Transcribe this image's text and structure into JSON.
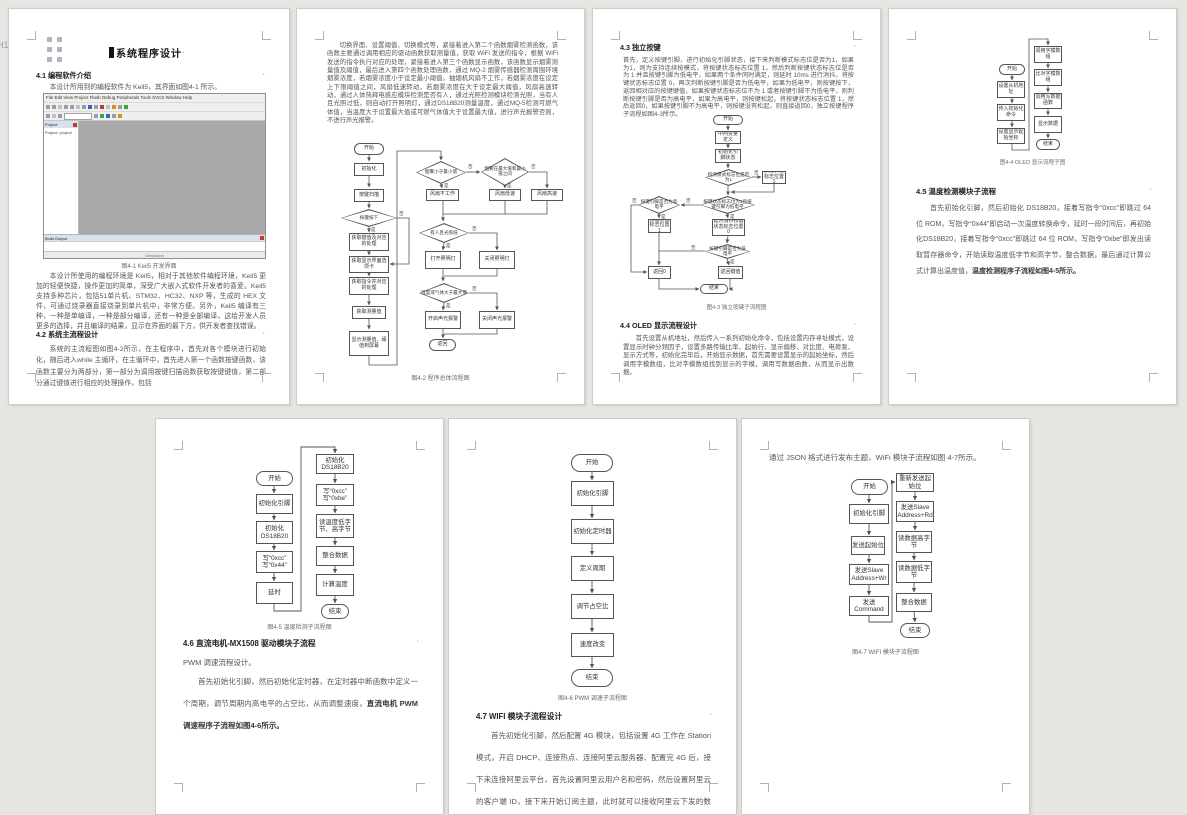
{
  "labels": {
    "yes": "是",
    "no": "否",
    "dot": "·",
    "h_level": "H1"
  },
  "page1": {
    "h1": "系统程序设计",
    "h2_41": "4.1 编程软件介绍",
    "p_intro": "本设计所用到的编程软件为 Keil5，其界面如图4-1 所示。",
    "keil": {
      "menu": "File  Edit  View  Project  Flash  Debug  Peripherals  Tools  SVCS  Window  Help",
      "project": "Project",
      "tree_item": "Project: project",
      "build_output": "Build Output",
      "status": "Simulation"
    },
    "caption": "图4-1 Keil5 开发界面",
    "p_keil": "本设计所使用的编程环境是 Keil5，相对于其他软件编程环境，Keil5 更加的轻便快捷，操作更加的简单，深受广大嵌入式软件开发者的喜爱。Keil5 支持多种芯片，包括51单片机、STM32、HC32、NXP 等，生成的 HEX 文件，可通过烧录器直接烧录到单片机中，非常方便。另外，Keil5 编译有三种，一种是单编译，一种是部分编译，还有一种是全部编译，这给开发人员更多的选择，并且编译的结果，显示在界面的最下方，供开发者查找错误。",
    "h2_42": "4.2 系统主流程设计",
    "p_42": "系统的主流程图如图4-2所示，在主程序中，首先对各个模块进行初始化，随后进入while 主循环，在主循环中，首先进入第一个函数按键函数，该函数主要分为两部分，第一部分为调用按键扫描函数获取按键键值，第二部分通过键值进行相应的处理操作，包括"
  },
  "page2": {
    "p_top": "切换界面、设置阈值、切换模式等，紧接着进入第二个函数烟雾检测函数，该函数主要通过调用相应的驱动函数获取测量值，获取 WiFi 发送的指令，根据 WiFi 发送的指令执行对应的处理，紧接着进入第三个函数显示函数，该函数显示烟雾测量值及阈值，最后进入第四个函数处理函数，通过 MQ-2 烟雾传感器检测周围环境烟雾浓度，若烟雾浓度小于设定最小阈值，抽烟机风扇不工作，若烟雾浓度在设定上下限阈值之间，风扇低速转动，若烟雾浓度在大于设定最大阈值，风扇高速转动，通过人体热释电感应模块检测是否有人，通过光照检测模块检测光照，当有人且光照过低，则自动打开照明灯，通过DS18B20测量温度，通过MQ-5检测可燃气体值，当温度大于设置最大值或可燃气体值大于设置最大值，进行声光报警否则，不进行声光报警。",
    "caption": "图4-2 程序总体流程图",
    "fc": {
      "start": "开始",
      "init": "初始化",
      "scan": "按键扫描",
      "d_press": "按键按下",
      "get_key": "获取键值及对应的处理",
      "get_page": "获取显示界面选项卡",
      "get_cmd": "获取指令并对应的处理",
      "get_val": "获取测量值",
      "show_val": "显示测量值、阈值到屏幕",
      "d_low": "烟雾小于最小值",
      "d_mid": "烟雾在最大值和最小值之间",
      "fan_off": "风扇不工作",
      "fan_low": "风扇低速",
      "fan_high": "风扇高速",
      "d_person": "有人且光照低",
      "lamp_on": "打开照明灯",
      "lamp_off": "关闭照明灯",
      "d_alarm": "温度或气体大于最大值",
      "alarm_on": "开启声光报警",
      "alarm_off": "关闭声光报警",
      "ret": "返回"
    }
  },
  "page3": {
    "h2_43": "4.3 独立按键",
    "p_43": "首先，定义按键引脚，进行初始化引脚状态，接下来判断模式标志位是否为1，如果为1，则为支持连续按模式，将按键状态标志位置 1，然后判断按键状态标志位是否为 1 并且按键引脚为低电平，如果两个条件同时满足，则延时 10ms 进行消抖，将按键状态标志位置 0，再次判断按键引脚是否为低电平，如果为低电平，则按键按下，返回相对应的按键键值，如果按键状态标志位不为 1 或者按键引脚不为低电平，则判断按键引脚是否为高电平，如果为高电平，则按键松起，将按键状态标志位置 1，然后返回0，如果按键引脚不为高电平，则按键没有松起，则直接返回0，独立按键程序子流程如图4-3所示。",
    "caption": "图4-3 独立按键子流程图",
    "h2_44": "4.4 OLED 显示流程设计",
    "p_44": "首先设置从机地址，然后传入一系列初始化命令，包括设置内存寻址模式，设置显示时钟分频因子，设置多路传输比率、起始行、显示偏移、对比度、电荷泵、显示方式等，初始化完毕后，开始显示数据，首先需要设置显示的起始坐标，然后调用字模数组，比对字模数组找到显示的字模，调用写数据函数，从而显示出数据。",
    "fc": {
      "start": "开始",
      "vars": "中间变量定义",
      "init": "初始化引脚状态",
      "d_mode": "检测模式标志位是否为1",
      "set_flag": "按键状态标志位置1",
      "d_cond": "按键状态标志位为1且按键引脚为低电平",
      "d_high": "按键引脚是否为高电平",
      "set_flag2": "按键状态标志位置1",
      "debounce": "延时消抖按键状态标志位置0",
      "d_low": "按键引脚是否为低电平",
      "ret0": "返回0",
      "retv": "返回键值",
      "end": "结束"
    }
  },
  "page4": {
    "caption": "图4-4 OLED 显示流程子图",
    "h2_45": "4.5 温度检测模块子流程",
    "p_45": "首先初始化引脚，然后初始化 DS18B20，接着写指令“0xcc”即跳过 64 位 ROM，写指令“0x44”即启动一次温度转换命令，延时一段时间后，再初始化DS18B20，接着写指令“0xcc”即跳过 64 位 ROM，写指令“0xbe”即发出读取暂存器命令，开始读取温度低字节和高字节，整合数据，最后通过计算公式计算出温度值，",
    "p_45_bold": "温度检测程序子流程如图4-5所示。",
    "fc": {
      "start": "开始",
      "addr": "设置从机地址",
      "cmds": "传入初始化命令",
      "coord": "设置显示起始坐标",
      "font": "调用字模数组",
      "match": "比对字模数组",
      "write": "调用写数据函数",
      "show": "显示数据",
      "end": "结束"
    }
  },
  "page5": {
    "caption": "图4-5 温度检测子流程图",
    "h2_46": "4.6 直流电机-MX1508 驱动模块子流程",
    "p_sub": "PWM 调速流程设计。",
    "p_46": "首先初始化引脚，然后初始化定时器，在定时器中断函数中定义一个周期，调节周期内高电平的占空比，从而调整速度，",
    "p_46_bold": "直流电机 PWM 调速程序子流程如图4-6所示。",
    "fc": {
      "start": "开始",
      "pin": "初始化引脚",
      "ds1": "初始化DS18B20",
      "w1a": "写“0xcc”",
      "w1b": "写“0x44”",
      "delay": "延时",
      "ds2": "初始化DS18B20",
      "w2a": "写“0xcc”",
      "w2b": "写“0xbe”",
      "read": "读温度低字节、高字节",
      "merge": "整合数据",
      "calc": "计算温度",
      "end": "结束"
    }
  },
  "page6": {
    "caption": "图4-6 PWM 调速子流程图",
    "h2_47": "4.7 WIFI 模块子流程设计",
    "p_47": "首先初始化引脚，然后配置 4G 模块，包括设置 4G 工作在 Station 模式，开启 DHCP、连接热点、连接阿里云服务器、配置完 4G 后，接下来连接阿里云平台，首先设置阿里云用户名和密码，然后设置阿里云的客户端 ID，接下来开始订阅主题，此时就可以接收阿里云下发的数据，如果想要上传数据，则",
    "fc": {
      "start": "开始",
      "pin": "初始化引脚",
      "timer": "初始化定时器",
      "period": "定义周期",
      "duty": "调节占空比",
      "speed": "速度改变",
      "end": "结束"
    }
  },
  "page7": {
    "p_top": "通过 JSON 格式进行发布主题，WiFi 模块子流程如图 4-7所示。",
    "caption": "图4-7 WIFI 模块子流程图",
    "fc": {
      "start": "开始",
      "pin": "初始化引脚",
      "sbit": "发送起始位",
      "wr": "发送Slave Address+Wr",
      "cmd": "发送Command",
      "restart": "重新发送起始位",
      "rd": "发送Slave Address+Rd",
      "rdh": "读数据高字节",
      "rdl": "读数据低字节",
      "merge": "整合数据",
      "end": "结束"
    }
  }
}
